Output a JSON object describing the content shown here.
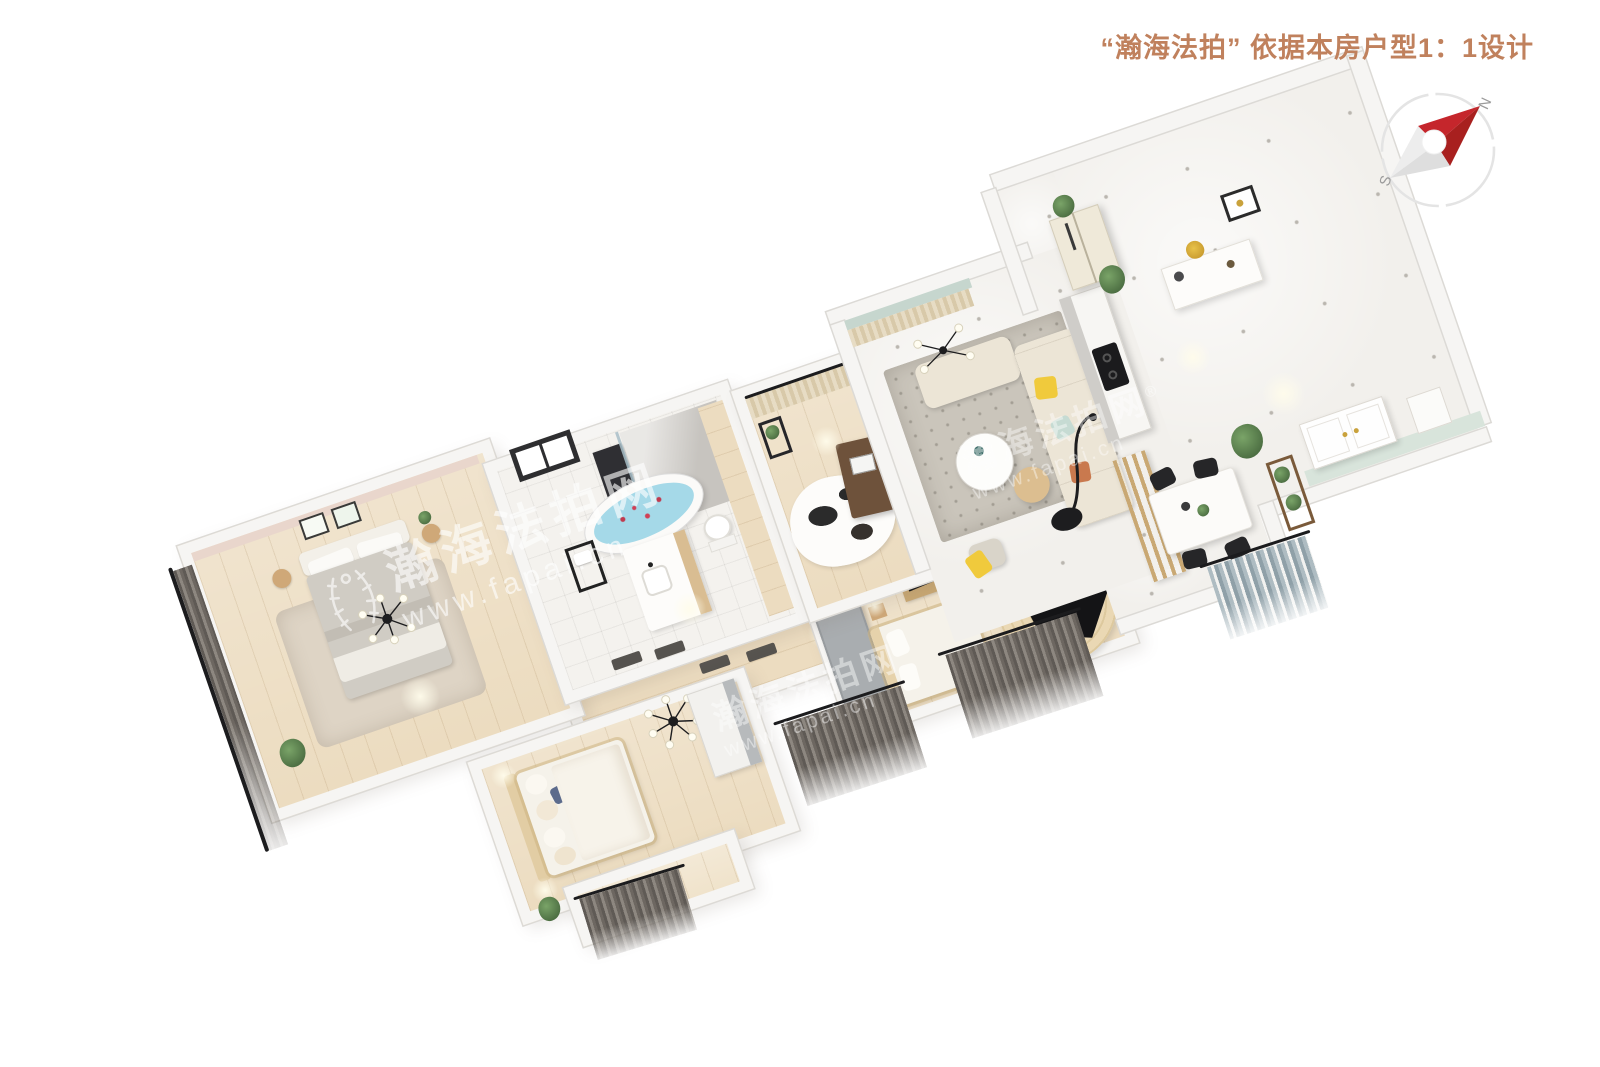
{
  "page": {
    "width": 1600,
    "height": 1067,
    "background": "#ffffff"
  },
  "header": {
    "title": "“瀚海法拍” 依据本房户型1：1设计",
    "color": "#c0815d"
  },
  "compass": {
    "north_label": "N",
    "south_label": "S",
    "colors": {
      "needle_red": "#c5262c",
      "needle_red_dark": "#a8201f",
      "needle_gray": "#ededed",
      "needle_gray_dark": "#dedede",
      "ring": "#e4e4e4",
      "labels": "#9b9b9b"
    }
  },
  "watermark": {
    "brand": "瀚海法拍网",
    "url": "www.fapai.cn",
    "reg_mark": "®",
    "color": "#ffffff"
  },
  "floor_plan": {
    "rotation_deg": -19,
    "regions": [
      {
        "id": "master-bedroom"
      },
      {
        "id": "bathroom"
      },
      {
        "id": "study"
      },
      {
        "id": "hallway"
      },
      {
        "id": "living-room"
      },
      {
        "id": "kitchen-bar"
      },
      {
        "id": "entry-hall"
      },
      {
        "id": "dining-area"
      },
      {
        "id": "bedroom-2"
      },
      {
        "id": "piano-area"
      },
      {
        "id": "bedroom-3"
      },
      {
        "id": "balcony"
      }
    ],
    "palette": {
      "title_color": "#c0815d",
      "wall": "#f6f5f3",
      "wall_edge": "#dcdad6",
      "wood": "#ecdcc0",
      "tile": "#f4f2ee",
      "marble": "#f2f0ec",
      "accent_pink": "#e9d6cc",
      "accent_teal": "#c6d6ce",
      "accent_mint": "#d8e4db",
      "curtain_beige": "#e7dcc4",
      "rug_gray": "#cac5bb",
      "rug_round": "#ead8b4",
      "sofa": "#ece5d6",
      "pillow_yellow": "#f0ca3c",
      "pillow_teal": "#c6dbd3",
      "pillow_orange": "#c9794e",
      "wood_furn": "#c9a873",
      "dark": "#26262a",
      "water_blue": "#a5d9e8",
      "bed_white": "#f5f2ea",
      "blanket_gray": "#d0ccc4"
    }
  }
}
